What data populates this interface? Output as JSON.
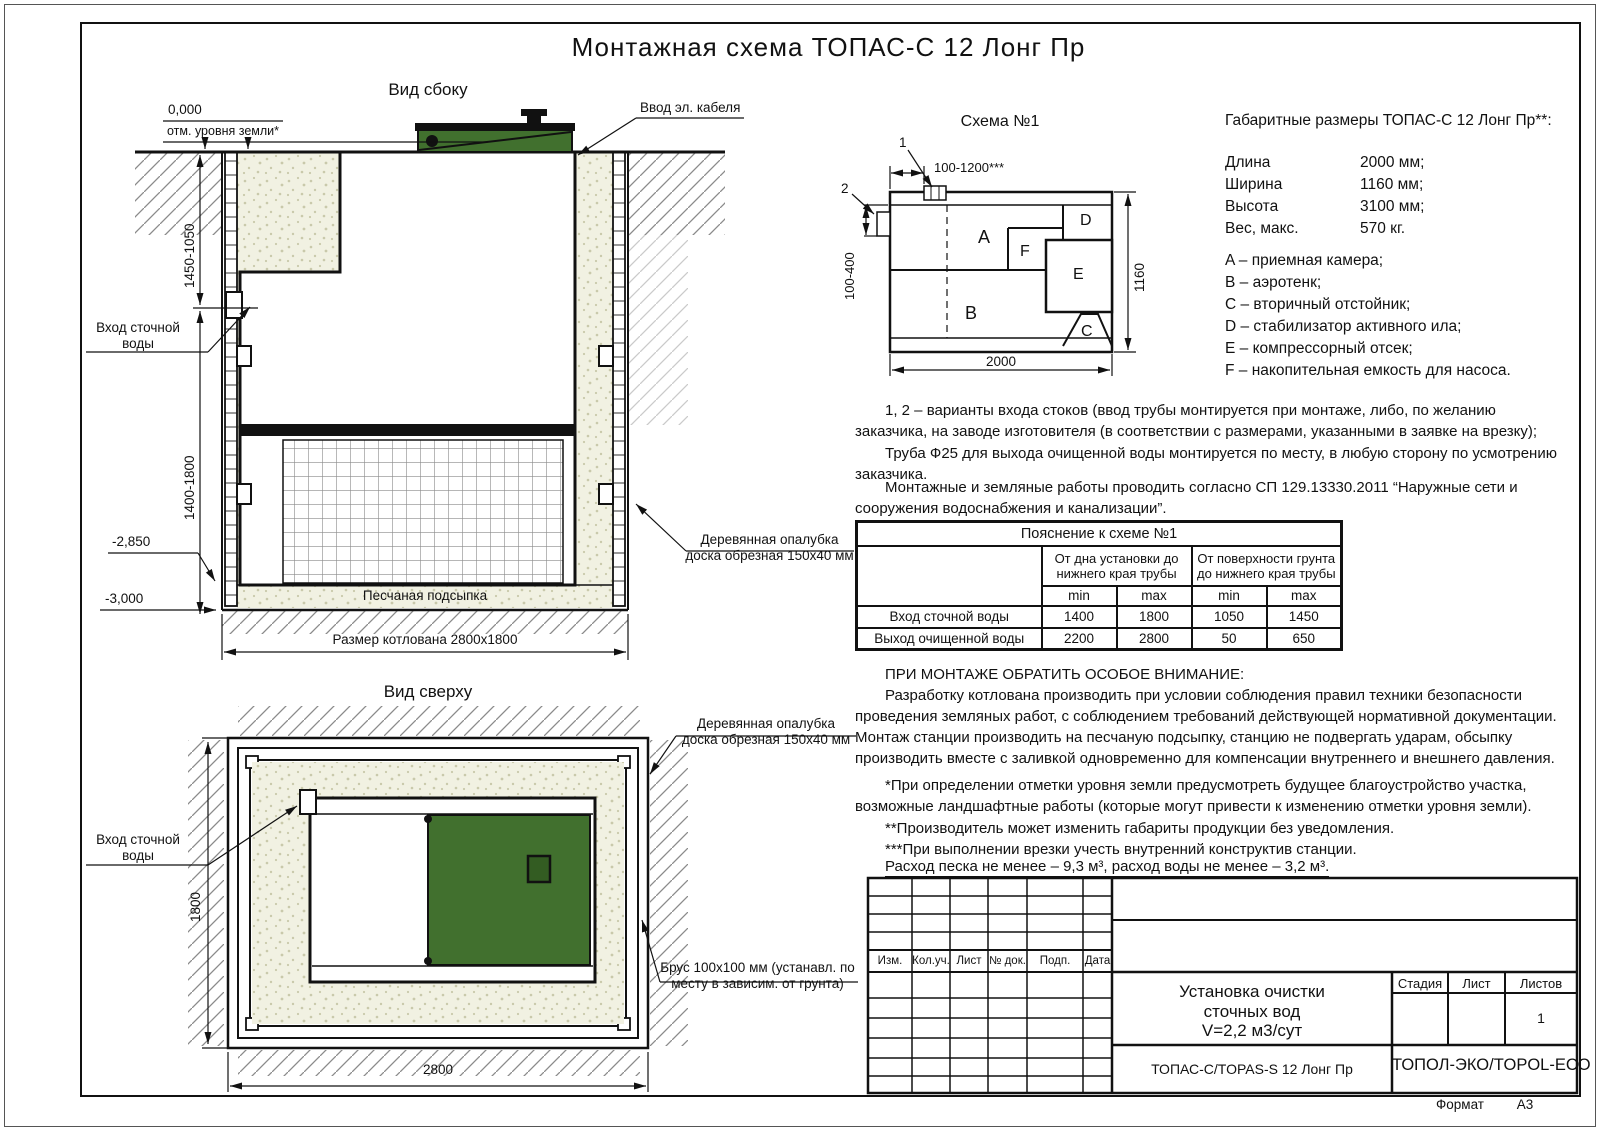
{
  "title": "Монтажная схема ТОПАС-С 12 Лонг Пр",
  "side_view": {
    "label": "Вид сбоку",
    "elevation_zero": "0,000",
    "ground_note": "отм. уровня земли*",
    "cable_label": "Ввод эл. кабеля",
    "inlet_label": "Вход сточной\nводы",
    "dim_upper": "1450-1050",
    "dim_lower": "1400-1800",
    "elev_2850": "-2,850",
    "elev_3000": "-3,000",
    "sand_label": "Песчаная подсыпка",
    "pit_dim": "Размер котлована 2800х1800",
    "formwork_label": "Деревянная опалубка\nдоска обрезная 150х40 мм"
  },
  "top_view": {
    "label": "Вид сверху",
    "inlet_label": "Вход сточной\nводы",
    "dim_height": "1800",
    "dim_width": "2800",
    "formwork_label": "Деревянная опалубка\nдоска обрезная 150х40 мм",
    "beam_label": "Брус 100х100 мм (устанавл. по\nместу в зависим. от грунта)"
  },
  "schema": {
    "title": "Схема №1",
    "callout_1": "1",
    "callout_2": "2",
    "dim_top": "100-1200***",
    "dim_left": "100-400",
    "dim_right": "1160",
    "dim_bottom": "2000",
    "compartments": {
      "a": "A",
      "b": "B",
      "c": "C",
      "d": "D",
      "e": "E",
      "f": "F"
    }
  },
  "specs": {
    "title": "Габаритные размеры ТОПАС-С 12 Лонг Пр**:",
    "rows": [
      {
        "label": "Длина",
        "value": "2000 мм;"
      },
      {
        "label": "Ширина",
        "value": "1160 мм;"
      },
      {
        "label": "Высота",
        "value": "3100 мм;"
      },
      {
        "label": "Вес, макс.",
        "value": "570 кг."
      }
    ],
    "legend": [
      "A – приемная камера;",
      "B – аэротенк;",
      "C – вторичный отстойник;",
      "D – стабилизатор активного ила;",
      "E – компрессорный отсек;",
      "F – накопительная емкость для насоса."
    ]
  },
  "notes": {
    "variants": "1, 2 – варианты входа  стоков (ввод трубы монтируется при монтаже, либо, по желанию заказчика, на заводе изготовителя (в соответствии с размерами, указанными в заявке на врезку);",
    "pipe": "Труба Ф25 для выхода очищенной воды монтируется по месту, в любую сторону по усмотрению заказчика.",
    "sp": "Монтажные и земляные работы проводить согласно СП 129.13330.2011 “Наружные сети и сооружения водоснабжения и канализации”."
  },
  "table": {
    "title": "Пояснение к схеме №1",
    "col_group_1": "От дна установки до\nнижнего края трубы",
    "col_group_2": "От поверхности грунта\nдо нижнего края трубы",
    "min": "min",
    "max": "max",
    "rows": [
      {
        "label": "Вход сточной воды",
        "v1": "1400",
        "v2": "1800",
        "v3": "1050",
        "v4": "1450"
      },
      {
        "label": "Выход очищенной воды",
        "v1": "2200",
        "v2": "2800",
        "v3": "50",
        "v4": "650"
      }
    ]
  },
  "attention": {
    "title": "ПРИ МОНТАЖЕ ОБРАТИТЬ ОСОБОЕ ВНИМАНИЕ:",
    "body": "Разработку котлована производить при условии соблюдения правил техники безопасности проведения земляных работ, с соблюдением требований действующей нормативной документации. Монтаж станции производить на песчаную подсыпку, станцию не подвергать ударам, обсыпку производить вместе с заливкой одновременно для компенсации внутреннего и внешнего давления."
  },
  "footnotes": [
    "*При определении отметки уровня земли предусмотреть будущее благоустройство участка, возможные ландшафтные работы (которые могут привести к изменению отметки уровня земли).",
    "**Производитель может изменить габариты продукции без уведомления.",
    "***При выполнении врезки учесть внутренний конструктив станции."
  ],
  "consumption": "Расход песка не менее – 9,3 м³, расход воды не менее – 3,2 м³.",
  "stamp": {
    "rev_headers": [
      "Изм.",
      "Кол.уч.",
      "Лист",
      "№ док.",
      "Подп.",
      "Дата"
    ],
    "project": "Установка очистки\nсточных вод\nV=2,2 м3/сут",
    "stage": "Стадия",
    "sheet": "Лист",
    "sheets": "Листов",
    "sheets_value": "1",
    "model": "ТОПАС-С/TOPAS-S 12 Лонг Пр",
    "company": "ТОПОЛ-ЭКО/TOPOL-ECO",
    "format_label": "Формат",
    "format_value": "А3"
  },
  "colors": {
    "lid_green": "#41702e",
    "sand": "#f1f1e2",
    "line": "#111111"
  }
}
